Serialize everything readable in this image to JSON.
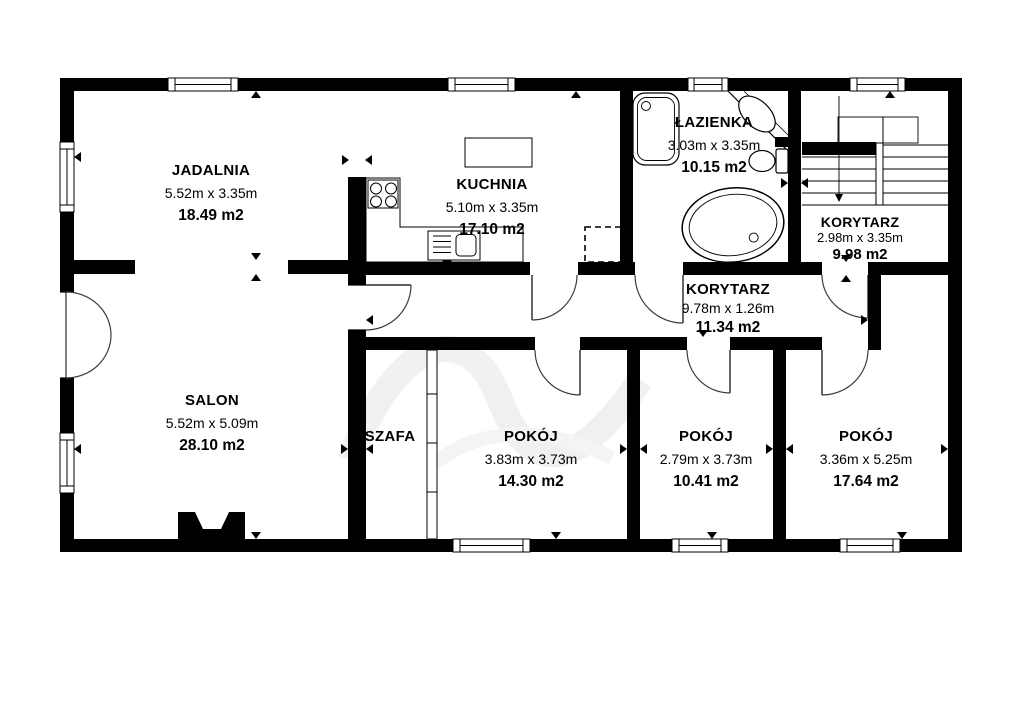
{
  "plan": {
    "type": "floor-plan",
    "colors": {
      "walls": "#000000",
      "background": "#ffffff",
      "door_arc": "#3a3a3a",
      "watermark": "#ebebeb"
    },
    "fixture_icons": [
      "staircase-icon",
      "bathtub-icon",
      "shower-icon",
      "toilet-icon",
      "corner-washbasin-icon",
      "kitchen-sink-icon",
      "stove-icon",
      "kitchen-island",
      "planned-appliance-dashed",
      "fireplace-icon",
      "wardrobe-sliding-doors",
      "double-entry-door",
      "window",
      "dimension-markers"
    ]
  },
  "rooms": [
    {
      "id": "jadalnia",
      "name": "JADALNIA",
      "dims": "5.52m x 3.35m",
      "area": "18.49 m2"
    },
    {
      "id": "kuchnia",
      "name": "KUCHNIA",
      "dims": "5.10m x 3.35m",
      "area": "17.10 m2"
    },
    {
      "id": "lazienka",
      "name": "ŁAZIENKA",
      "dims": "3.03m x 3.35m",
      "area": "10.15 m2"
    },
    {
      "id": "korytarz-gorny",
      "name": "KORYTARZ",
      "dims": "2.98m x 3.35m",
      "area": "9.98 m2"
    },
    {
      "id": "korytarz",
      "name": "KORYTARZ",
      "dims": "9.78m x 1.26m",
      "area": "11.34 m2"
    },
    {
      "id": "salon",
      "name": "SALON",
      "dims": "5.52m x 5.09m",
      "area": "28.10 m2"
    },
    {
      "id": "szafa",
      "name": "SZAFA"
    },
    {
      "id": "pokoj-1",
      "name": "POKÓJ",
      "dims": "3.83m x 3.73m",
      "area": "14.30 m2"
    },
    {
      "id": "pokoj-2",
      "name": "POKÓJ",
      "dims": "2.79m x 3.73m",
      "area": "10.41 m2"
    },
    {
      "id": "pokoj-3",
      "name": "POKÓJ",
      "dims": "3.36m x 5.25m",
      "area": "17.64 m2"
    }
  ]
}
